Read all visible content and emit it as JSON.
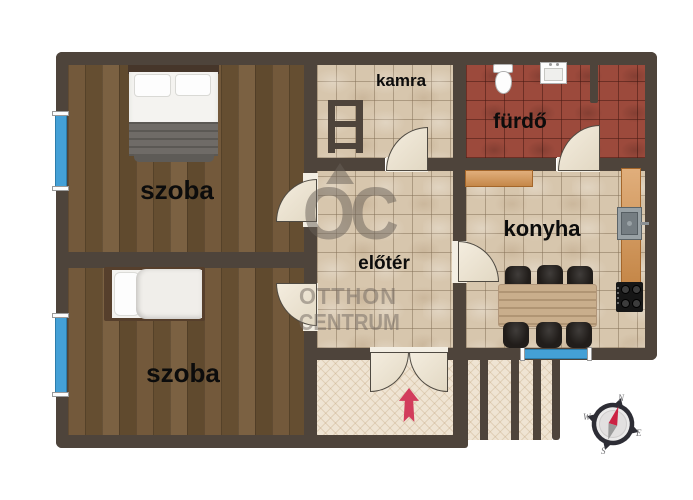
{
  "document": {
    "type": "residential-floor-plan"
  },
  "rooms": [
    {
      "key": "bedroom-1",
      "label": "szoba",
      "floor": "wood",
      "furniture": [
        "double-bed"
      ]
    },
    {
      "key": "bedroom-2",
      "label": "szoba",
      "floor": "wood",
      "furniture": [
        "single-bed"
      ]
    },
    {
      "key": "pantry",
      "label": "kamra",
      "floor": "beige-tile",
      "furniture": [
        "shelf-ladder"
      ]
    },
    {
      "key": "bathroom",
      "label": "fürdő",
      "floor": "red-tile",
      "furniture": [
        "toilet",
        "washbasin"
      ]
    },
    {
      "key": "kitchen",
      "label": "konyha",
      "floor": "beige-tile",
      "furniture": [
        "counter-top",
        "counter-right",
        "kitchen-sink",
        "stove",
        "dining-table",
        "six-chairs"
      ]
    },
    {
      "key": "hall",
      "label": "előtér",
      "floor": "beige-tile",
      "furniture": []
    }
  ],
  "exterior": {
    "porch": "entrance-porch-with-double-door",
    "steps": "four-exterior-steps",
    "entrance_marker": "red-arrow-up"
  },
  "windows": [
    "bedroom-1-left-wall",
    "bedroom-2-left-wall",
    "kitchen-bottom-wall"
  ],
  "watermark": {
    "logo": "OC",
    "line1": "OTTHON",
    "line2": "CENTRUM"
  },
  "compass": {
    "n": "N",
    "e": "E",
    "s": "S",
    "w": "W"
  },
  "colors": {
    "wall": "#4e443b",
    "wood_floor": "#6d5436",
    "tile_floor": "#d7c6ad",
    "bath_tile": "#9c4a3c",
    "porch_floor": "#efe4d3",
    "window": "#44a0d6",
    "door_leaf": "#eee6d6",
    "counter": "#d6934f",
    "entrance_arrow": "#d23c5c",
    "watermark": "#6b6158"
  }
}
